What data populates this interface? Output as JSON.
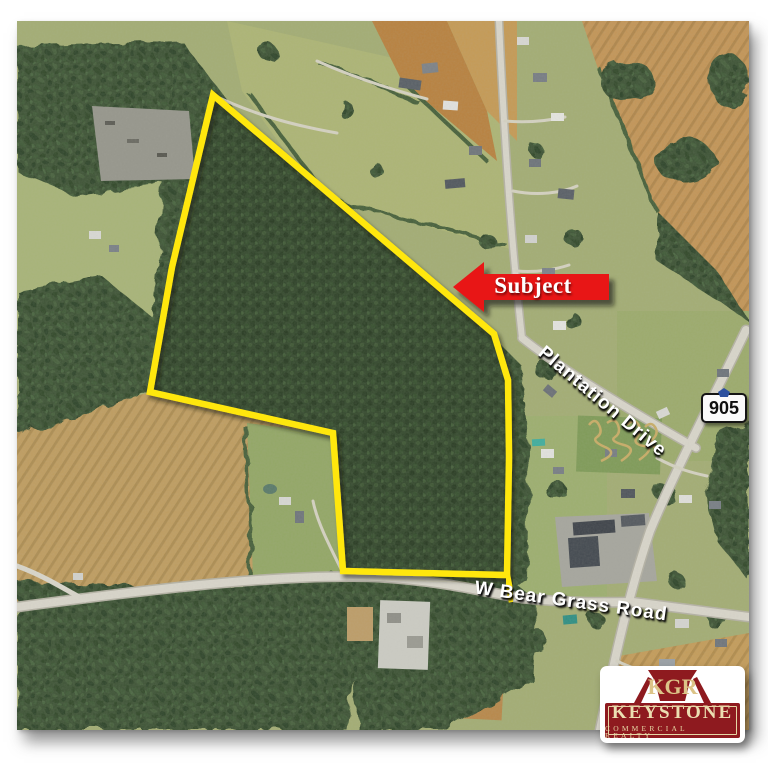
{
  "annotations": {
    "subject_label": "Subject",
    "plantation_drive": "Plantation Drive",
    "bear_grass_road": "W Bear Grass Road",
    "route_number": "905"
  },
  "logo": {
    "monogram": "KGR",
    "company": "KEYSTONE",
    "tagline": "COMMERCIAL REALTY"
  },
  "colors": {
    "boundary_yellow": "#ffe70e",
    "arrow_red": "#e81417",
    "logo_red": "#8e1a1f",
    "logo_cream": "#e6d7a5",
    "shield_blue": "#2b4f9e"
  }
}
